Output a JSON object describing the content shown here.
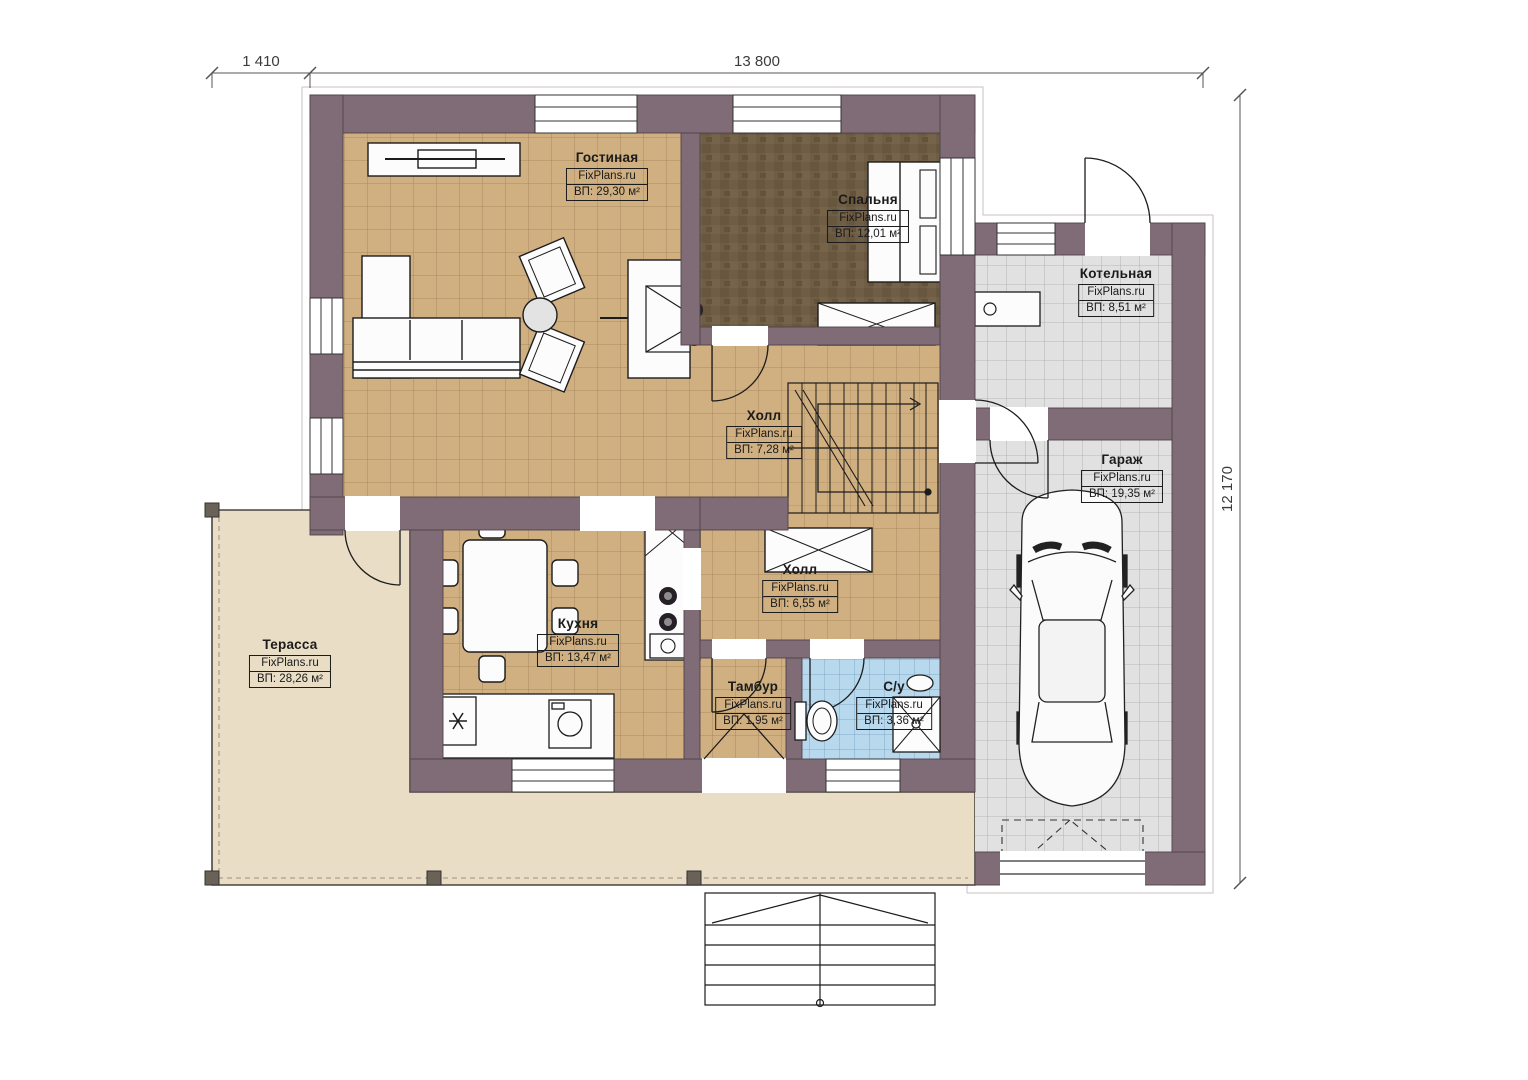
{
  "plan": {
    "brand": "FixPlans.ru",
    "dimensions": {
      "terrace_width": "1 410",
      "house_width": "13 800",
      "house_depth": "12 170"
    },
    "rooms": [
      {
        "id": "living",
        "name": "Гостиная",
        "area": "ВП: 29,30 м²"
      },
      {
        "id": "bedroom",
        "name": "Спальня",
        "area": "ВП: 12,01 м²"
      },
      {
        "id": "boiler",
        "name": "Котельная",
        "area": "ВП: 8,51 м²"
      },
      {
        "id": "garage",
        "name": "Гараж",
        "area": "ВП: 19,35 м²"
      },
      {
        "id": "hall_up",
        "name": "Холл",
        "area": "ВП: 7,28 м²"
      },
      {
        "id": "hall_low",
        "name": "Холл",
        "area": "ВП: 6,55 м²"
      },
      {
        "id": "kitchen",
        "name": "Кухня",
        "area": "ВП: 13,47 м²"
      },
      {
        "id": "terrace",
        "name": "Терасса",
        "area": "ВП: 28,26 м²"
      },
      {
        "id": "vestibule",
        "name": "Тамбур",
        "area": "ВП: 1,95 м²"
      },
      {
        "id": "bathroom",
        "name": "С/у",
        "area": "ВП: 3,36 м²"
      }
    ],
    "colors": {
      "wall": "#806c76",
      "floor_tan": "#d0af81",
      "floor_gray": "#e1e1e1",
      "floor_blue": "#b7d8ed",
      "floor_bedroom": "#6f5d45",
      "terrace": "#e9ddc6"
    }
  }
}
